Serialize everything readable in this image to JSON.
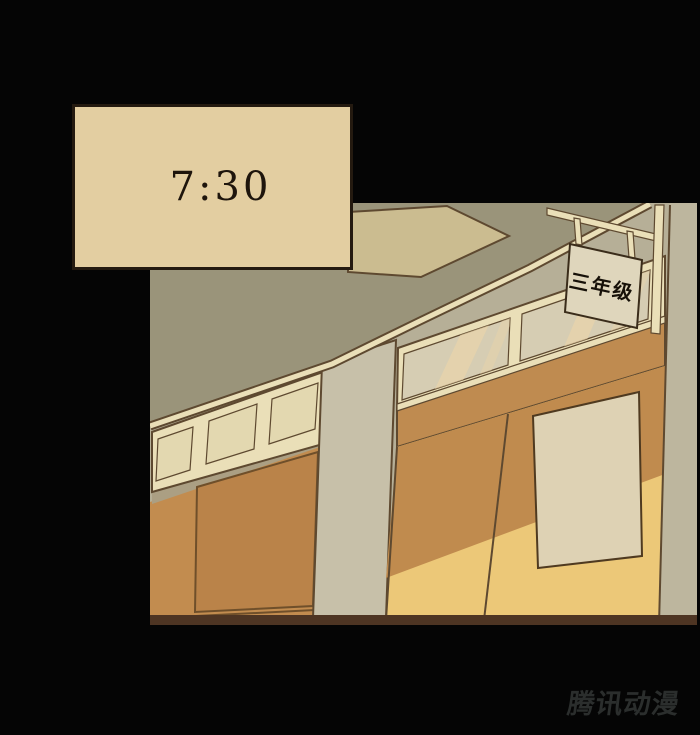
{
  "panel": {
    "caption": {
      "time": "7:30"
    },
    "classroom_sign": {
      "label": "三年级"
    },
    "watermark": {
      "text": "腾讯动漫"
    }
  },
  "colors": {
    "background": "#050505",
    "caption_fill": "#E3CEA1",
    "caption_border": "#241A10",
    "caption_text": "#1E150C",
    "wall_olive": "#9A947A",
    "wall_light": "#B6AF97",
    "ceiling_panel": "#CBBC90",
    "pillar_mid": "#C7C0A9",
    "pillar_right": "#BDB69E",
    "frame_cream": "#EADFB8",
    "glass_left": "#E3D8B0",
    "glass_right": "#D6CDB3",
    "glass_streak": "#ECD5A9",
    "sill_shadow": "#AB9F83",
    "orange_wall": "#C28C4F",
    "orange_board": "#BA8349",
    "lintel_orange": "#BF8B50",
    "door_dark": "#C08B4E",
    "door_light": "#ECC878",
    "door_pane": "#DED2B4",
    "sign_fill": "#DFD6BC",
    "sign_text": "#161008",
    "outline_dark": "#5E4930",
    "floor_strip": "#4E3523",
    "watermark_color": "#2B2E2D"
  }
}
